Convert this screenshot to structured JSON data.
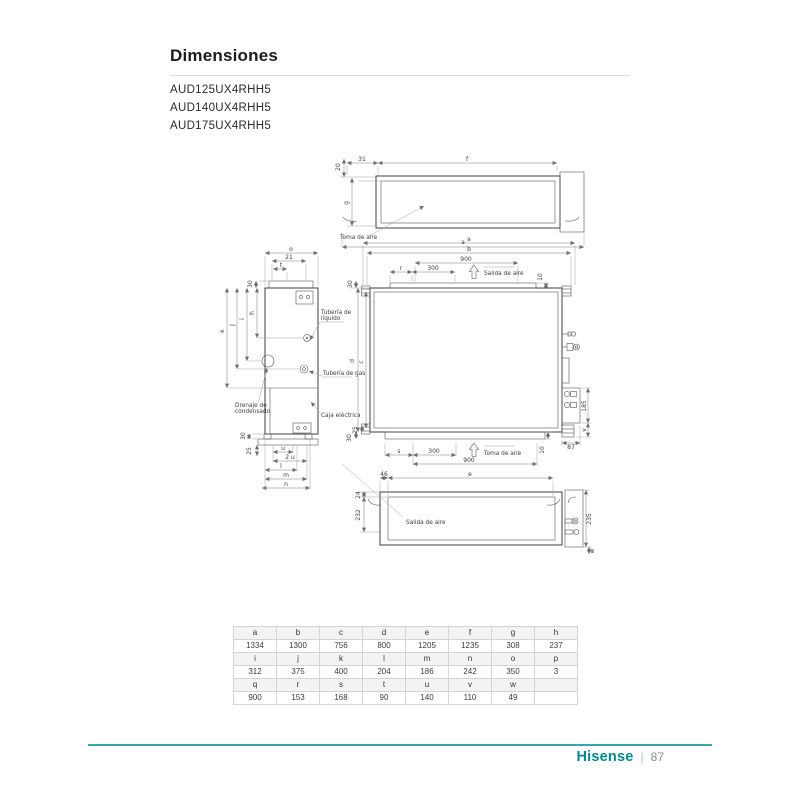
{
  "page": {
    "title": "Dimensiones",
    "models": [
      "AUD125UX4RHH5",
      "AUD140UX4RHH5",
      "AUD175UX4RHH5"
    ],
    "footer": {
      "brand": "Hisense",
      "separator": "|",
      "page_number": "87"
    }
  },
  "colors": {
    "brand_teal": "#00898f",
    "footer_rule_teal": "#35a8ac",
    "drawing_line": "#555555",
    "table_header_bg": "#f3f3f3"
  },
  "drawings": {
    "labels": {
      "toma": "Toma de aire",
      "salida": "Salida de aire",
      "tub_liq1": "Tubería de",
      "tub_liq2": "líquido",
      "tub_gas": "Tubería de gas",
      "dren1": "Drenaje de",
      "dren2": "condensado",
      "caja": "Caja eléctrica"
    },
    "top": {
      "d20": "20",
      "d31": "31",
      "df": "f",
      "dg": "g",
      "da": "a"
    },
    "side": {
      "dO": "o",
      "d21": "21",
      "dt": "t",
      "d30t": "30",
      "dk": "k",
      "dj": "j",
      "di": "i",
      "dh": "h",
      "d30b": "30",
      "d25": "25",
      "du": "u",
      "d2u": "2 u",
      "dl": "l",
      "dm": "m",
      "dn": "n"
    },
    "front": {
      "da": "a",
      "db": "b",
      "d900t": "900",
      "dr": "r",
      "d300t": "300",
      "d10t": "10",
      "d30lt": "30",
      "dd": "d",
      "dc": "c",
      "d25": "25",
      "d30lb": "30",
      "ds": "s",
      "d300b": "300",
      "d900b": "900",
      "d10b": "10",
      "d185": "185",
      "dv": "v",
      "d87": "87"
    },
    "bottom": {
      "d46": "46",
      "de": "e",
      "d24": "24",
      "d232": "232",
      "d235": "235",
      "dw": "w"
    }
  },
  "table": {
    "rows": [
      {
        "type": "header",
        "cells": [
          "a",
          "b",
          "c",
          "d",
          "e",
          "f",
          "g",
          "h"
        ]
      },
      {
        "type": "value",
        "cells": [
          "1334",
          "1300",
          "756",
          "800",
          "1205",
          "1235",
          "308",
          "237"
        ]
      },
      {
        "type": "header",
        "cells": [
          "i",
          "j",
          "k",
          "l",
          "m",
          "n",
          "o",
          "p"
        ]
      },
      {
        "type": "value",
        "cells": [
          "312",
          "375",
          "400",
          "204",
          "186",
          "242",
          "350",
          "3"
        ]
      },
      {
        "type": "header",
        "cells": [
          "q",
          "r",
          "s",
          "t",
          "u",
          "v",
          "w",
          ""
        ]
      },
      {
        "type": "value",
        "cells": [
          "900",
          "153",
          "168",
          "90",
          "140",
          "110",
          "49",
          ""
        ]
      }
    ]
  }
}
